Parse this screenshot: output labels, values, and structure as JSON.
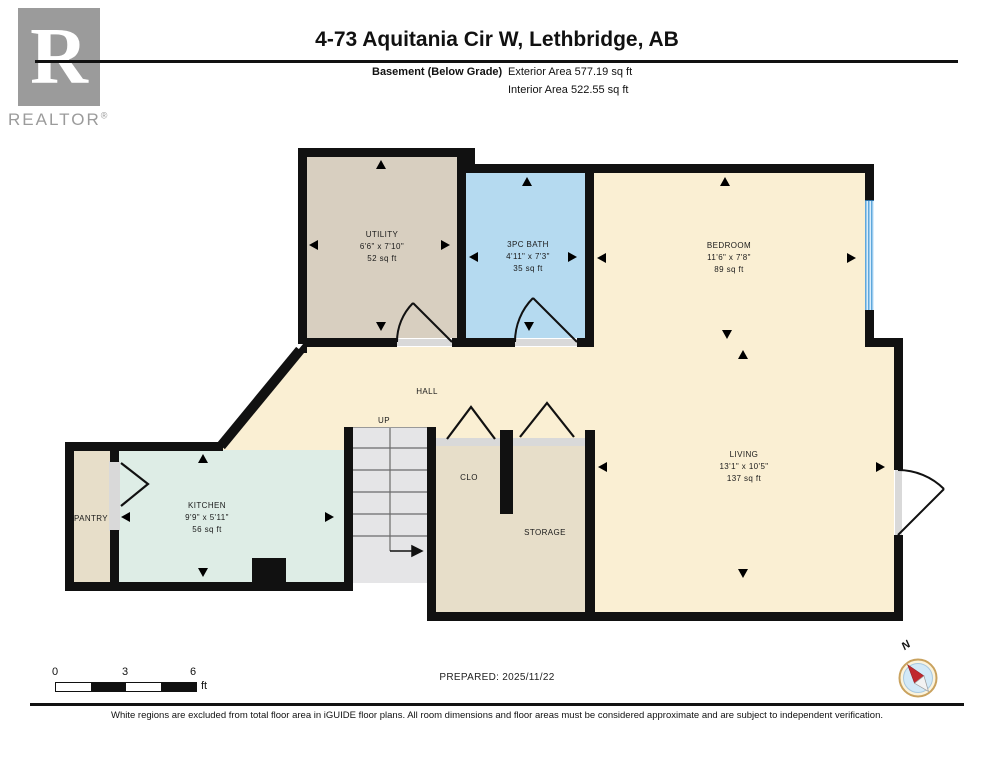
{
  "header": {
    "logo": {
      "letter": "R",
      "brand": "REALTOR",
      "registered": "®"
    },
    "title": "4-73 Aquitania Cir W, Lethbridge, AB",
    "floor_label": "Basement (Below Grade)",
    "exterior_area": "Exterior Area 577.19 sq ft",
    "interior_area": "Interior Area 522.55 sq ft"
  },
  "rooms": {
    "utility": {
      "name": "UTILITY",
      "dims": "6'6\" x 7'10\"",
      "area": "52 sq ft"
    },
    "bath": {
      "name": "3PC BATH",
      "dims": "4'11\" x 7'3\"",
      "area": "35 sq ft"
    },
    "bedroom": {
      "name": "BEDROOM",
      "dims": "11'6\" x 7'8\"",
      "area": "89 sq ft"
    },
    "living": {
      "name": "LIVING",
      "dims": "13'1\" x 10'5\"",
      "area": "137 sq ft"
    },
    "kitchen": {
      "name": "KITCHEN",
      "dims": "9'9\" x 5'11\"",
      "area": "56 sq ft"
    },
    "hall": {
      "name": "HALL"
    },
    "up": {
      "name": "UP"
    },
    "clo": {
      "name": "CLO"
    },
    "storage": {
      "name": "STORAGE"
    },
    "pantry": {
      "name": "PANTRY"
    }
  },
  "footer": {
    "scale": {
      "ticks": [
        "0",
        "3",
        "6"
      ],
      "unit": "ft"
    },
    "prepared": "PREPARED: 2025/11/22",
    "compass_label": "N",
    "disclaimer": "White regions are excluded from total floor area in iGUIDE floor plans. All room dimensions and floor areas must be considered approximate and are subject to independent verification."
  },
  "colors": {
    "wall": "#111111",
    "open_area_cream": "#FAEFD3",
    "utility_tan": "#D8CFC0",
    "bath_blue": "#B5DAF0",
    "kitchen_mint": "#DEEDE6",
    "closet_beige": "#E7DEC9",
    "stairs_gray": "#E5E5E7",
    "window_blue": "#5FA8DC",
    "threshold_gray": "#D9D9D9",
    "logo_gray": "#9B9B9B",
    "compass_red": "#C0272D"
  }
}
